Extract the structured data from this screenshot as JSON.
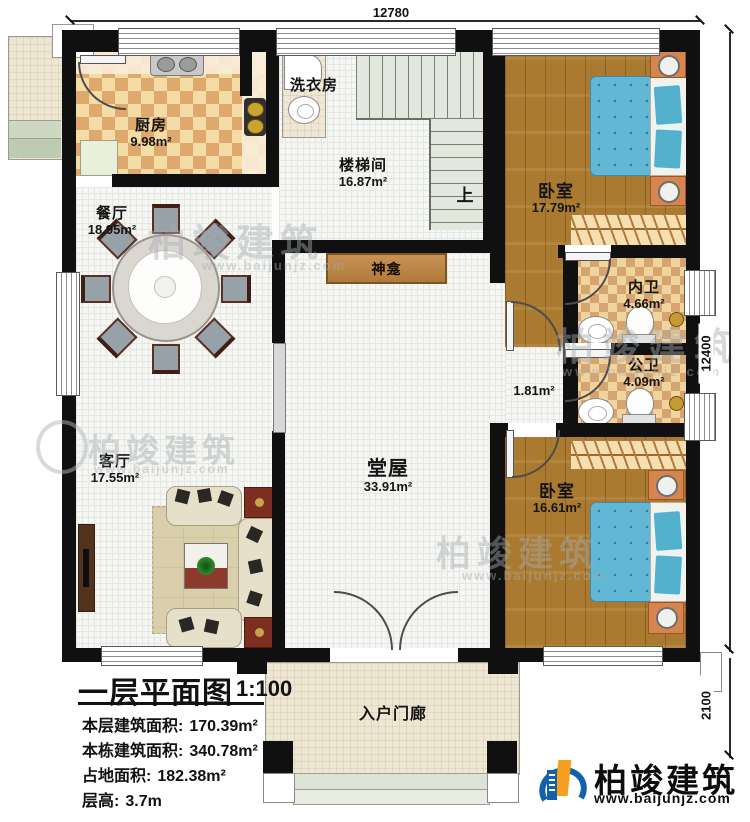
{
  "dimensions": {
    "width_top": "12780",
    "height_right": "12400",
    "porch_height": "2100"
  },
  "rooms": {
    "kitchen": {
      "name": "厨房",
      "area": "9.98m²"
    },
    "laundry": {
      "name": "洗衣房"
    },
    "stairwell": {
      "name": "楼梯间",
      "area": "16.87m²",
      "direction": "上"
    },
    "dining": {
      "name": "餐厅",
      "area": "18.95m²"
    },
    "bedroom_top": {
      "name": "卧室",
      "area": "17.79m²"
    },
    "ensuite_bath": {
      "name": "内卫",
      "area": "4.66m²"
    },
    "public_bath": {
      "name": "公卫",
      "area": "4.09m²"
    },
    "shrine": {
      "name": "神龛"
    },
    "hall": {
      "name": "堂屋",
      "area": "33.91m²"
    },
    "living": {
      "name": "客厅",
      "area": "17.55m²"
    },
    "bedroom_bottom": {
      "name": "卧室",
      "area": "16.61m²"
    },
    "corridor": {
      "area": "1.81m²"
    },
    "porch": {
      "name": "入户门廊"
    }
  },
  "title_block": {
    "title": "一层平面图",
    "scale": "1:100",
    "stats": [
      {
        "label": "本层建筑面积:",
        "value": "170.39m²"
      },
      {
        "label": "本栋建筑面积:",
        "value": "340.78m²"
      },
      {
        "label": "占地面积:",
        "value": "182.38m²"
      },
      {
        "label": "层高:",
        "value": "3.7m"
      }
    ]
  },
  "brand": {
    "name": "柏竣建筑",
    "website": "www.baijunjz.com"
  },
  "colors": {
    "wall": "#101010",
    "wood": "#aa7a30",
    "checker": "#dfa96e",
    "bed_blue": "#62b8d4",
    "logo_blue": "#1460aa",
    "logo_orange": "#f5a01e"
  }
}
